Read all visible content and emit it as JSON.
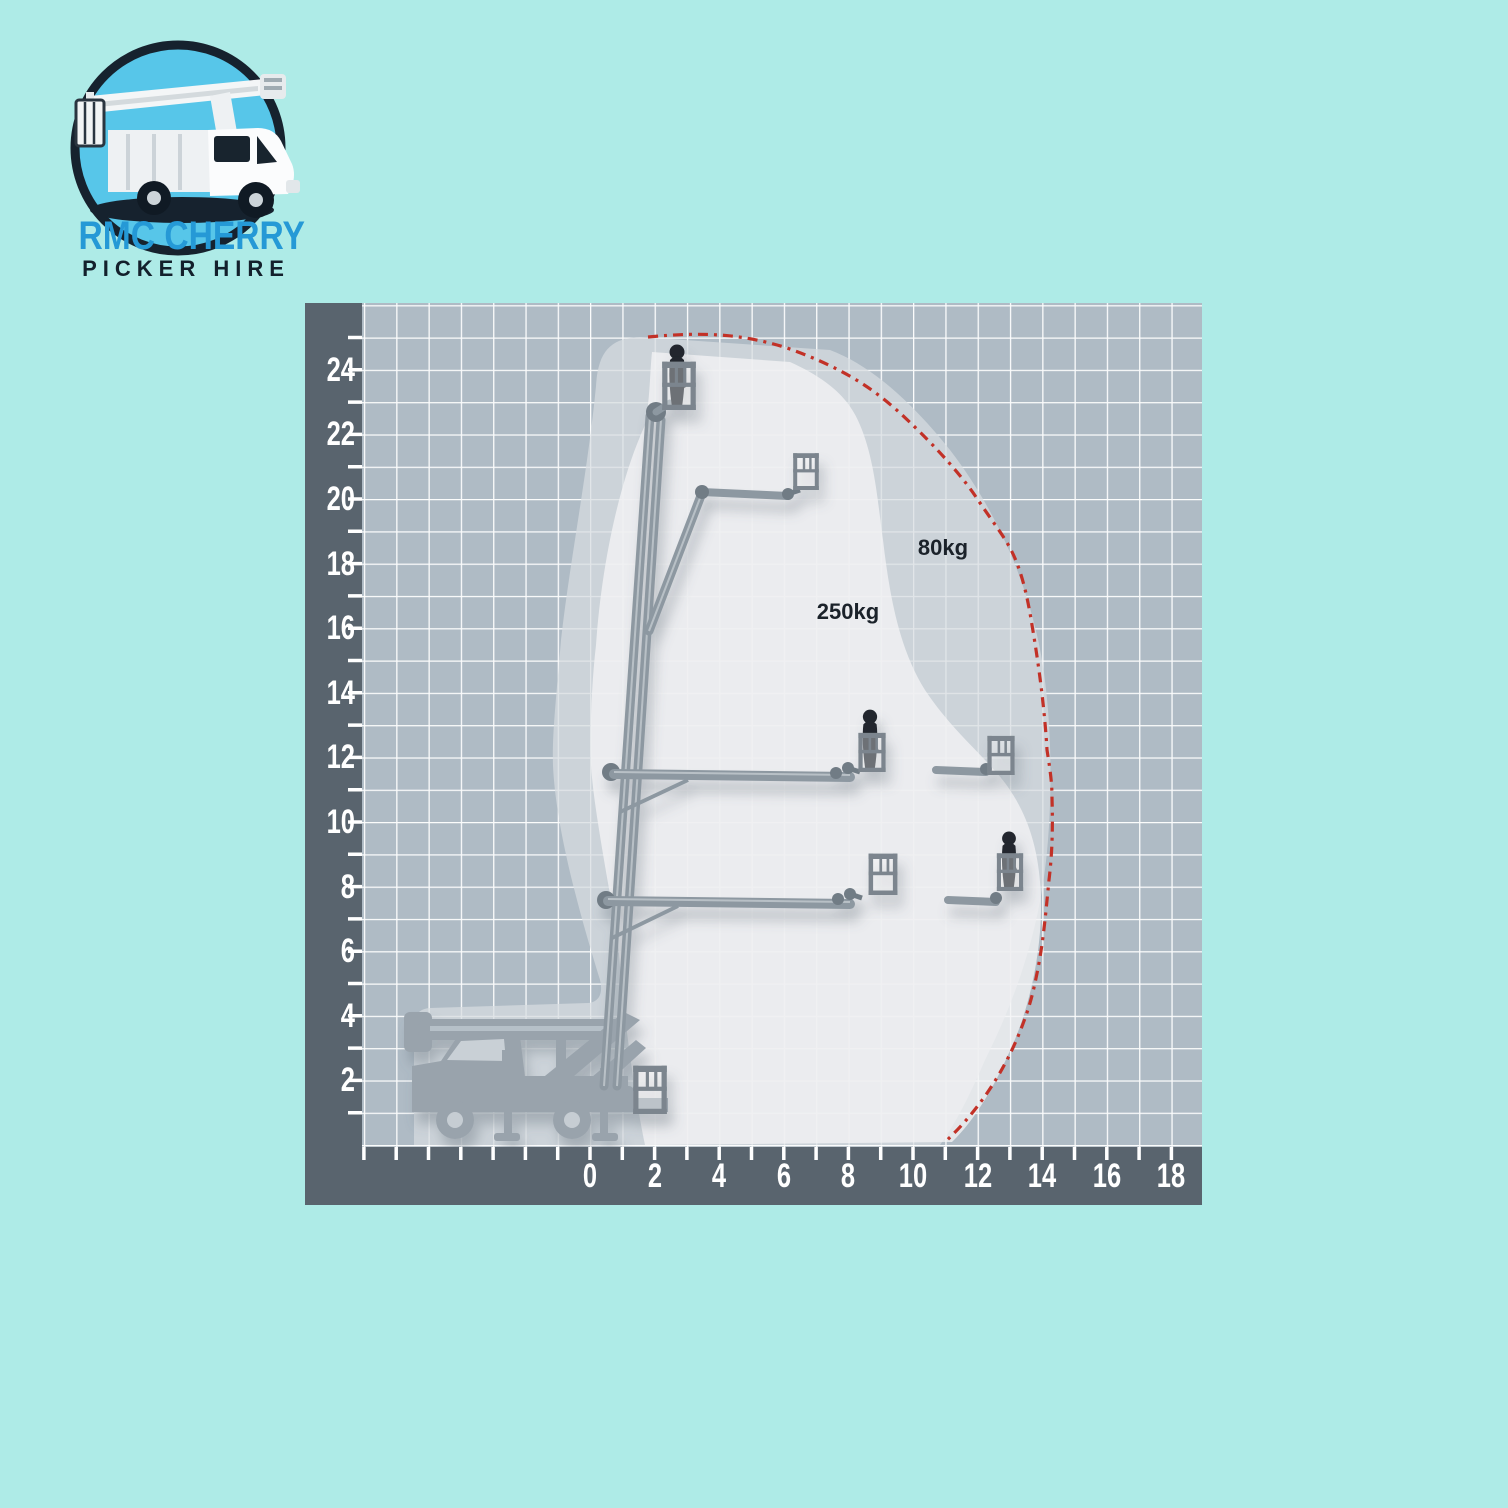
{
  "page": {
    "background_color": "#aeebe7"
  },
  "logo": {
    "icon": "cherry-picker-truck-emblem",
    "line1": "RMC CHERRY",
    "line2": "PICKER HIRE",
    "line1_color": "#2599d6",
    "line2_color": "#13202c"
  },
  "chart": {
    "axis_text_color": "#ffffff",
    "frame_color": "#59646e",
    "grid_background": "#afbbc5",
    "grid_line_color": "#ffffff",
    "envelope_fill_80kg": "#d7dce0",
    "envelope_fill_250kg": "#f3f4f5",
    "limit_line_color": "#c23127",
    "machine_color": "#8d98a1",
    "person_color": "#20262d",
    "y_axis": {
      "tick_values": [
        2,
        4,
        6,
        8,
        10,
        12,
        14,
        16,
        18,
        20,
        22,
        24
      ]
    },
    "x_axis": {
      "tick_values": [
        0,
        2,
        4,
        6,
        8,
        10,
        12,
        14,
        16,
        18
      ]
    },
    "zone_labels": [
      {
        "text": "80kg"
      },
      {
        "text": "250kg"
      }
    ]
  },
  "chart_data": {
    "type": "area",
    "title": "",
    "grid": true,
    "legend_position": "none",
    "x_axis_ticks": [
      0,
      2,
      4,
      6,
      8,
      10,
      12,
      14,
      16,
      18
    ],
    "y_axis_ticks": [
      2,
      4,
      6,
      8,
      10,
      12,
      14,
      16,
      18,
      20,
      22,
      24
    ],
    "x_range_visible": [
      -7,
      19
    ],
    "y_range_visible": [
      0,
      26
    ],
    "series": [
      {
        "name": "80kg work envelope limit (red dash-dot line)",
        "points_reach_height": [
          [
            1.9,
            25.0
          ],
          [
            6.1,
            24.7
          ],
          [
            9.6,
            22.7
          ],
          [
            12.0,
            20.0
          ],
          [
            13.0,
            18.5
          ],
          [
            13.7,
            16.1
          ],
          [
            14.1,
            12.2
          ],
          [
            14.3,
            10.8
          ],
          [
            14.2,
            8.2
          ],
          [
            13.9,
            5.6
          ],
          [
            13.5,
            3.9
          ],
          [
            11.0,
            0.0
          ]
        ]
      },
      {
        "name": "250kg zone boundary (light area)",
        "points_reach_height": [
          [
            8.4,
            22.4
          ],
          [
            9.1,
            19.7
          ],
          [
            9.9,
            15.6
          ],
          [
            11.9,
            13.2
          ],
          [
            13.6,
            11.0
          ],
          [
            13.9,
            6.0
          ],
          [
            13.0,
            3.3
          ],
          [
            11.1,
            0.2
          ]
        ]
      }
    ],
    "machine_poses": [
      {
        "pose": "stowed-on-truck",
        "basket_height": 1.2,
        "basket_reach": 1.8,
        "occupant": false
      },
      {
        "pose": "boom-vertical",
        "basket_height": 22.8,
        "basket_reach": 2.7,
        "occupant": true
      },
      {
        "pose": "articulated-up",
        "basket_height": 20.3,
        "basket_reach": 6.7,
        "occupant": false
      },
      {
        "pose": "horizontal-mid",
        "basket_height": 11.5,
        "basket_reach": 8.7,
        "occupant": true
      },
      {
        "pose": "horizontal-mid-max",
        "basket_height": 11.5,
        "basket_reach": 12.7,
        "occupant": false
      },
      {
        "pose": "horizontal-low",
        "basket_height": 7.7,
        "basket_reach": 9.1,
        "occupant": false
      },
      {
        "pose": "horizontal-low-max",
        "basket_height": 7.8,
        "basket_reach": 13.0,
        "occupant": true
      }
    ]
  }
}
